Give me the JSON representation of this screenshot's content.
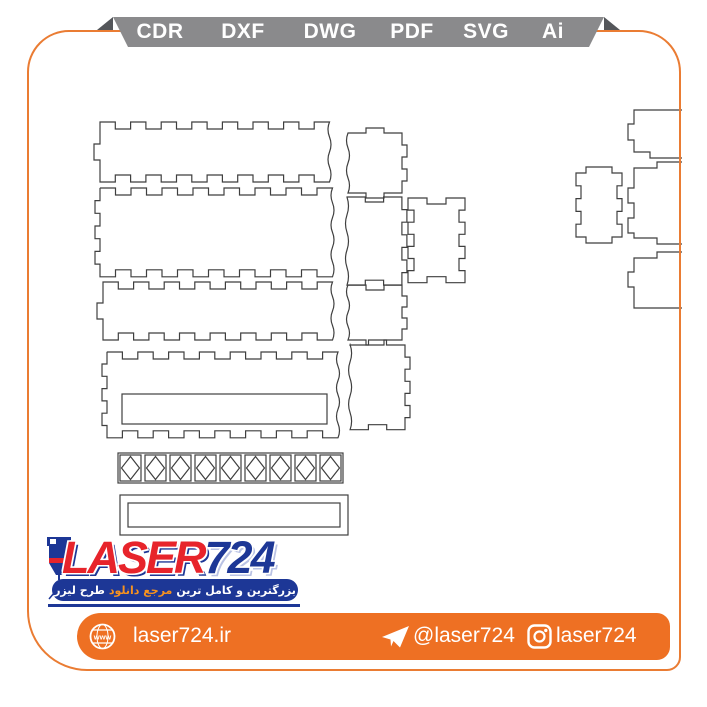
{
  "page": {
    "background": "#ffffff",
    "border_color": "#ea7c33"
  },
  "format_ribbon": {
    "band_color": "#8a8a8c",
    "fold_color": "#54565a",
    "text_color": "#ffffff",
    "items": [
      "CDR",
      "DXF",
      "DWG",
      "PDF",
      "SVG",
      "Ai"
    ]
  },
  "logo": {
    "brand_red_part": "LASER",
    "brand_blue_part": "724",
    "tagline_pre": "بزرگترین و کامل ترین",
    "tagline_highlight": "مرجع دانلود",
    "tagline_post": "طرح لیزر",
    "colors": {
      "red": "#e7242b",
      "navy": "#1d3796",
      "highlight_orange": "#f6921e"
    }
  },
  "footer": {
    "bar_color": "#ee7023",
    "website": "laser724.ir",
    "telegram": "@laser724",
    "instagram": "laser724"
  },
  "drawing": {
    "stroke": "#3f3f3f",
    "panels": [
      {
        "name": "long-panel-1",
        "x": 100,
        "y": 122,
        "w": 230,
        "h": 60,
        "edges": {
          "top": {
            "type": "fingers",
            "count": 7,
            "depth": 7,
            "dir": "in"
          },
          "right": {
            "type": "wave",
            "count": 4,
            "depth": 3
          },
          "bottom": {
            "type": "fingers",
            "count": 7,
            "depth": 7,
            "dir": "in"
          },
          "left": {
            "type": "tab",
            "width": 16,
            "depth": 6,
            "dir": "out"
          }
        }
      },
      {
        "name": "long-panel-2",
        "x": 100,
        "y": 188,
        "w": 233,
        "h": 89,
        "edges": {
          "top": {
            "type": "fingers",
            "count": 7,
            "depth": 7,
            "dir": "in"
          },
          "right": {
            "type": "wave",
            "count": 6,
            "depth": 3
          },
          "bottom": {
            "type": "fingers",
            "count": 7,
            "depth": 7,
            "dir": "in"
          },
          "left": {
            "type": "fingers",
            "count": 3,
            "depth": 5,
            "dir": "out"
          }
        }
      },
      {
        "name": "long-panel-3",
        "x": 103,
        "y": 282,
        "w": 230,
        "h": 58,
        "edges": {
          "top": {
            "type": "fingers",
            "count": 7,
            "depth": 7,
            "dir": "in"
          },
          "right": {
            "type": "wave",
            "count": 4,
            "depth": 3
          },
          "bottom": {
            "type": "fingers",
            "count": 7,
            "depth": 7,
            "dir": "in"
          },
          "left": {
            "type": "tab",
            "width": 16,
            "depth": 6,
            "dir": "out"
          }
        }
      },
      {
        "name": "long-panel-4-with-slot",
        "x": 107,
        "y": 352,
        "w": 231,
        "h": 86,
        "edges": {
          "top": {
            "type": "fingers",
            "count": 7,
            "depth": 7,
            "dir": "in"
          },
          "right": {
            "type": "wave",
            "count": 6,
            "depth": 3
          },
          "bottom": {
            "type": "fingers",
            "count": 7,
            "depth": 7,
            "dir": "in"
          },
          "left": {
            "type": "fingers",
            "count": 3,
            "depth": 5,
            "dir": "out"
          }
        },
        "slot": {
          "x": 122,
          "y": 394,
          "w": 205,
          "h": 30
        }
      },
      {
        "name": "small-panel-1",
        "x": 348,
        "y": 133,
        "w": 54,
        "h": 60,
        "edges": {
          "top": {
            "type": "tab",
            "width": 18,
            "depth": 5,
            "dir": "out"
          },
          "right": {
            "type": "fingers",
            "count": 2,
            "depth": 5,
            "dir": "out"
          },
          "bottom": {
            "type": "tab",
            "width": 18,
            "depth": 5,
            "dir": "out"
          },
          "left": {
            "type": "wave",
            "count": 4,
            "depth": 3
          }
        }
      },
      {
        "name": "small-panel-2",
        "x": 347,
        "y": 197,
        "w": 55,
        "h": 88,
        "edges": {
          "top": {
            "type": "fingers",
            "count": 1,
            "depth": 5,
            "dir": "in"
          },
          "right": {
            "type": "fingers",
            "count": 3,
            "depth": 5,
            "dir": "out"
          },
          "bottom": {
            "type": "fingers",
            "count": 1,
            "depth": 5,
            "dir": "in"
          },
          "left": {
            "type": "wave",
            "count": 5,
            "depth": 3
          }
        }
      },
      {
        "name": "small-panel-3",
        "x": 348,
        "y": 285,
        "w": 54,
        "h": 55,
        "edges": {
          "top": {
            "type": "fingers",
            "count": 1,
            "depth": 5,
            "dir": "in"
          },
          "right": {
            "type": "fingers",
            "count": 2,
            "depth": 5,
            "dir": "out"
          },
          "bottom": {
            "type": "tab",
            "width": 18,
            "depth": 5,
            "dir": "out"
          },
          "left": {
            "type": "wave",
            "count": 4,
            "depth": 3
          }
        }
      },
      {
        "name": "small-panel-4",
        "x": 350,
        "y": 345,
        "w": 55,
        "h": 85,
        "edges": {
          "top": {
            "type": "tab",
            "width": 18,
            "depth": 5,
            "dir": "out"
          },
          "right": {
            "type": "fingers",
            "count": 3,
            "depth": 5,
            "dir": "out"
          },
          "bottom": {
            "type": "fingers",
            "count": 1,
            "depth": 5,
            "dir": "in"
          },
          "left": {
            "type": "wave",
            "count": 5,
            "depth": 3
          }
        }
      },
      {
        "name": "end-panel-notched",
        "x": 408,
        "y": 198,
        "w": 57,
        "h": 85,
        "edges": {
          "top": {
            "type": "fingers",
            "count": 1,
            "depth": 6,
            "dir": "in"
          },
          "right": {
            "type": "fingers",
            "count": 3,
            "depth": 6,
            "dir": "in"
          },
          "bottom": {
            "type": "fingers",
            "count": 1,
            "depth": 6,
            "dir": "in"
          },
          "left": {
            "type": "fingers",
            "count": 3,
            "depth": 6,
            "dir": "in"
          }
        }
      },
      {
        "name": "right-end-panel",
        "x": 576,
        "y": 173,
        "w": 46,
        "h": 64,
        "edges": {
          "top": {
            "type": "tab",
            "width": 26,
            "depth": 6,
            "dir": "out"
          },
          "right": {
            "type": "fingers",
            "count": 2,
            "depth": 5,
            "dir": "in"
          },
          "bottom": {
            "type": "tab",
            "width": 26,
            "depth": 6,
            "dir": "out"
          },
          "left": {
            "type": "fingers",
            "count": 2,
            "depth": 5,
            "dir": "in"
          }
        }
      }
    ],
    "clipped_paths": [
      {
        "name": "clipped-panel-top",
        "d": "M682,110 L634,110 L634,124 L628,124 L628,140 L634,140 L634,152 L650,152 L650,158 L682,158"
      },
      {
        "name": "clipped-panel-middle",
        "d": "M682,162 L657,162 L657,168 L634,168 L634,188 L628,188 L628,203 L634,203 L634,218 L628,218 L628,233 L634,233 L634,238 L657,238 L657,244 L682,244"
      },
      {
        "name": "clipped-panel-bottom",
        "d": "M682,252 L657,252 L657,258 L634,258 L634,272 L628,272 L628,287 L634,287 L634,308 L682,308"
      }
    ],
    "lattice_strip": {
      "x": 118,
      "y": 453,
      "w": 225,
      "h": 30,
      "cells": 9
    },
    "frame_strip": {
      "outer": [
        120,
        495,
        228,
        40
      ],
      "inner": [
        128,
        503,
        212,
        24
      ]
    }
  }
}
